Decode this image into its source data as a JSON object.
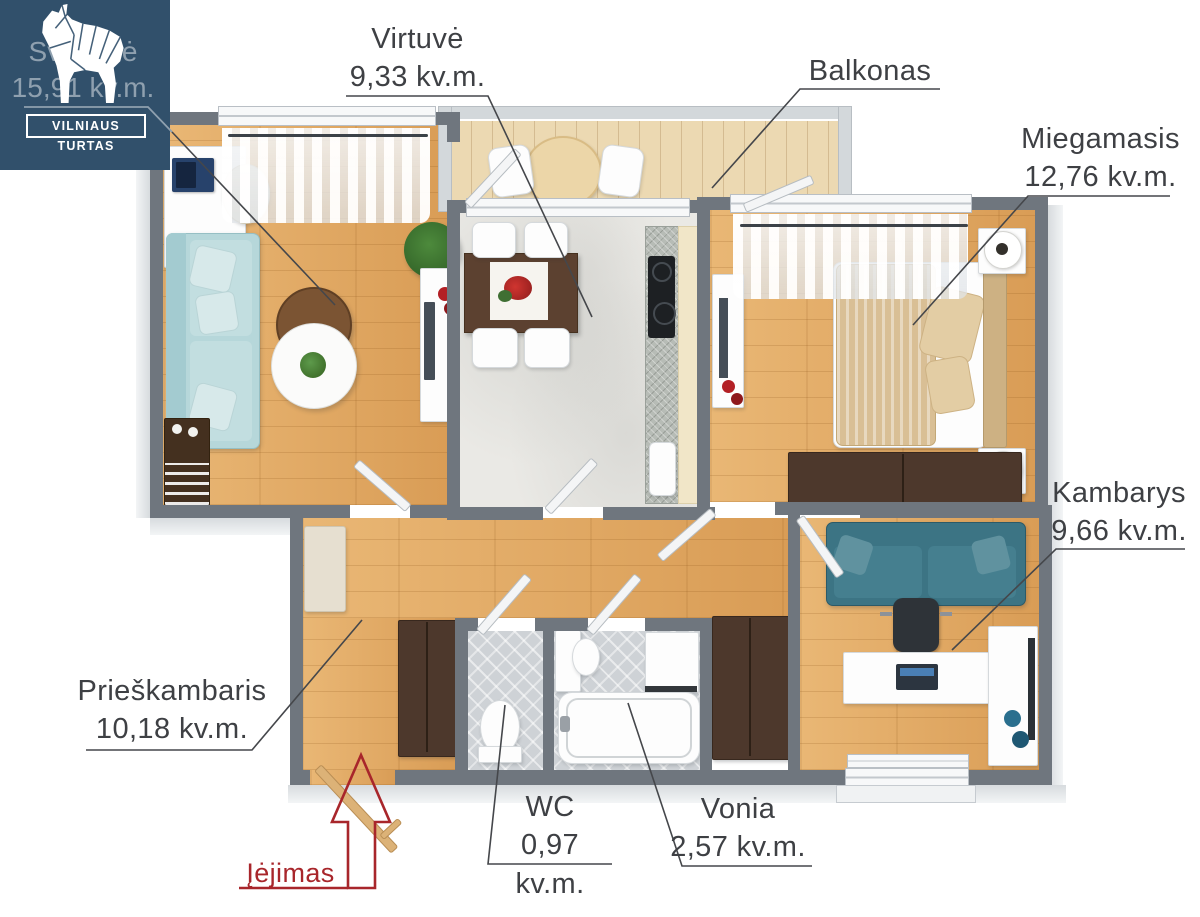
{
  "brand": {
    "name": "VILNIAUS TURTAS"
  },
  "labels": {
    "svetaine": {
      "name": "Svetainė",
      "area": "15,91 kv.m."
    },
    "virtuve": {
      "name": "Virtuvė",
      "area": "9,33 kv.m."
    },
    "balkonas": {
      "name": "Balkonas"
    },
    "miegamasis": {
      "name": "Miegamasis",
      "area": "12,76 kv.m."
    },
    "kambarys": {
      "name": "Kambarys",
      "area": "9,66 kv.m."
    },
    "prieskambaris": {
      "name": "Prieškambaris",
      "area": "10,18 kv.m."
    },
    "wc": {
      "name": "WC",
      "area": "0,97 kv.m."
    },
    "vonia": {
      "name": "Vonia",
      "area": "2,57 kv.m."
    },
    "entrance": {
      "name": "Įėjimas"
    }
  },
  "colors": {
    "logo_background": "#31506b",
    "label_text": "#3e4044",
    "entrance_accent": "#a8262b",
    "wall": "#6f767e",
    "wood_floor": "#e0a55e",
    "balcony_floor": "#ecd9b2",
    "marble_floor": "#eae9e5",
    "tile_floor": "#ced2d6",
    "living_sofa": "#b6d7da",
    "kambarys_sofa": "#3c7484",
    "bed_cover": "#d9bf95",
    "dark_wood_furniture": "#4d382c"
  }
}
